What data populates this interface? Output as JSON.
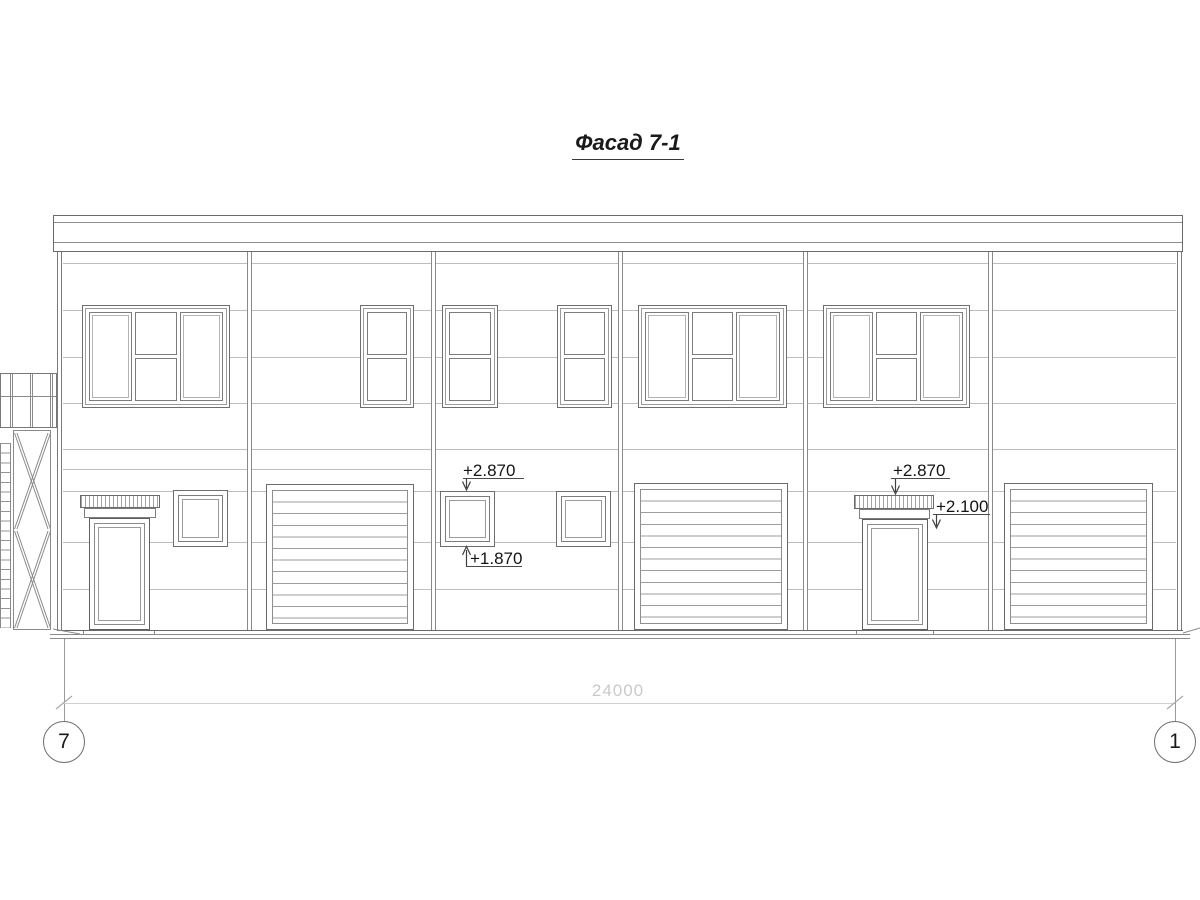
{
  "drawing": {
    "title": "Фасад 7-1",
    "elevation_marks": [
      {
        "id": "left-window-top",
        "label": "+2.870"
      },
      {
        "id": "left-window-bottom",
        "label": "+1.870"
      },
      {
        "id": "right-canopy-top",
        "label": "+2.870"
      },
      {
        "id": "right-door-head",
        "label": "+2.100"
      }
    ],
    "dimension": {
      "overall_width": "24000"
    },
    "axes": [
      {
        "label": "7"
      },
      {
        "label": "1"
      }
    ],
    "colors": {
      "background": "#ffffff",
      "outline": "#6a6a6a",
      "panel_joint": "#bdbdbd",
      "dim_faint": "#cccccc",
      "text": "#141414"
    }
  }
}
